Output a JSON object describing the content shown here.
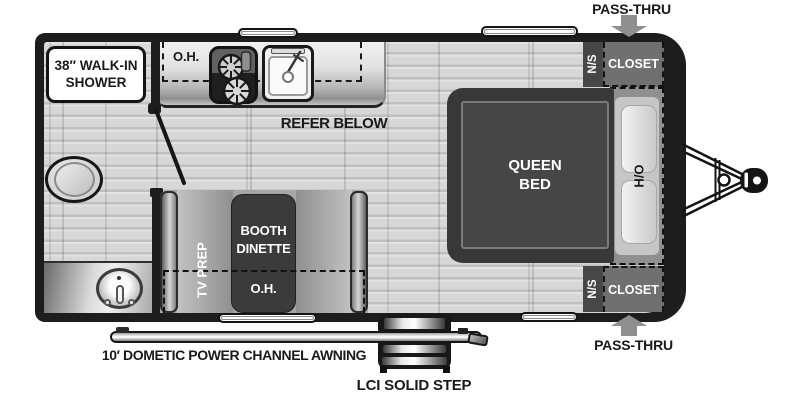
{
  "diagram_title": "Travel trailer floor plan",
  "exterior": {
    "pass_thru_top": "PASS-THRU",
    "pass_thru_bottom": "PASS-THRU",
    "awning_label": "10′ DOMETIC POWER CHANNEL AWNING",
    "step_label": "LCI SOLID STEP"
  },
  "bathroom": {
    "shower_line1": "38″ WALK-IN",
    "shower_line2": "SHOWER"
  },
  "kitchen": {
    "overhead_label": "O.H.",
    "refer_label": "REFER BELOW"
  },
  "dinette": {
    "tv_prep_label": "TV PREP",
    "booth_line1": "BOOTH",
    "booth_line2": "DINETTE",
    "overhead_label": "O.H."
  },
  "bedroom": {
    "bed_line1": "QUEEN",
    "bed_line2": "BED",
    "ho_label": "H/O",
    "ns_top": "N/S",
    "closet_top": "CLOSET",
    "ns_bottom": "N/S",
    "closet_bottom": "CLOSET"
  },
  "icons": [
    "toilet-icon",
    "bath-sink-icon",
    "cooktop-icon",
    "kitchen-sink-icon",
    "roof-vent-icon",
    "window-icon",
    "entry-door-icon",
    "entry-step-icon",
    "awning-bar-icon",
    "hitch-icon",
    "pass-thru-arrow-icon",
    "door-swing-icon"
  ],
  "colors": {
    "wall": "#1d1d1d",
    "floor": "#d6d6d6",
    "furniture_dark": "#3b3b3b",
    "bench_gray": "#a6a6a6",
    "closet_gray": "#707070",
    "nightstand_gray": "#474747",
    "arrow_gray": "#8f8f8f",
    "label_white": "#ffffff",
    "label_black": "#1a1a1a"
  }
}
